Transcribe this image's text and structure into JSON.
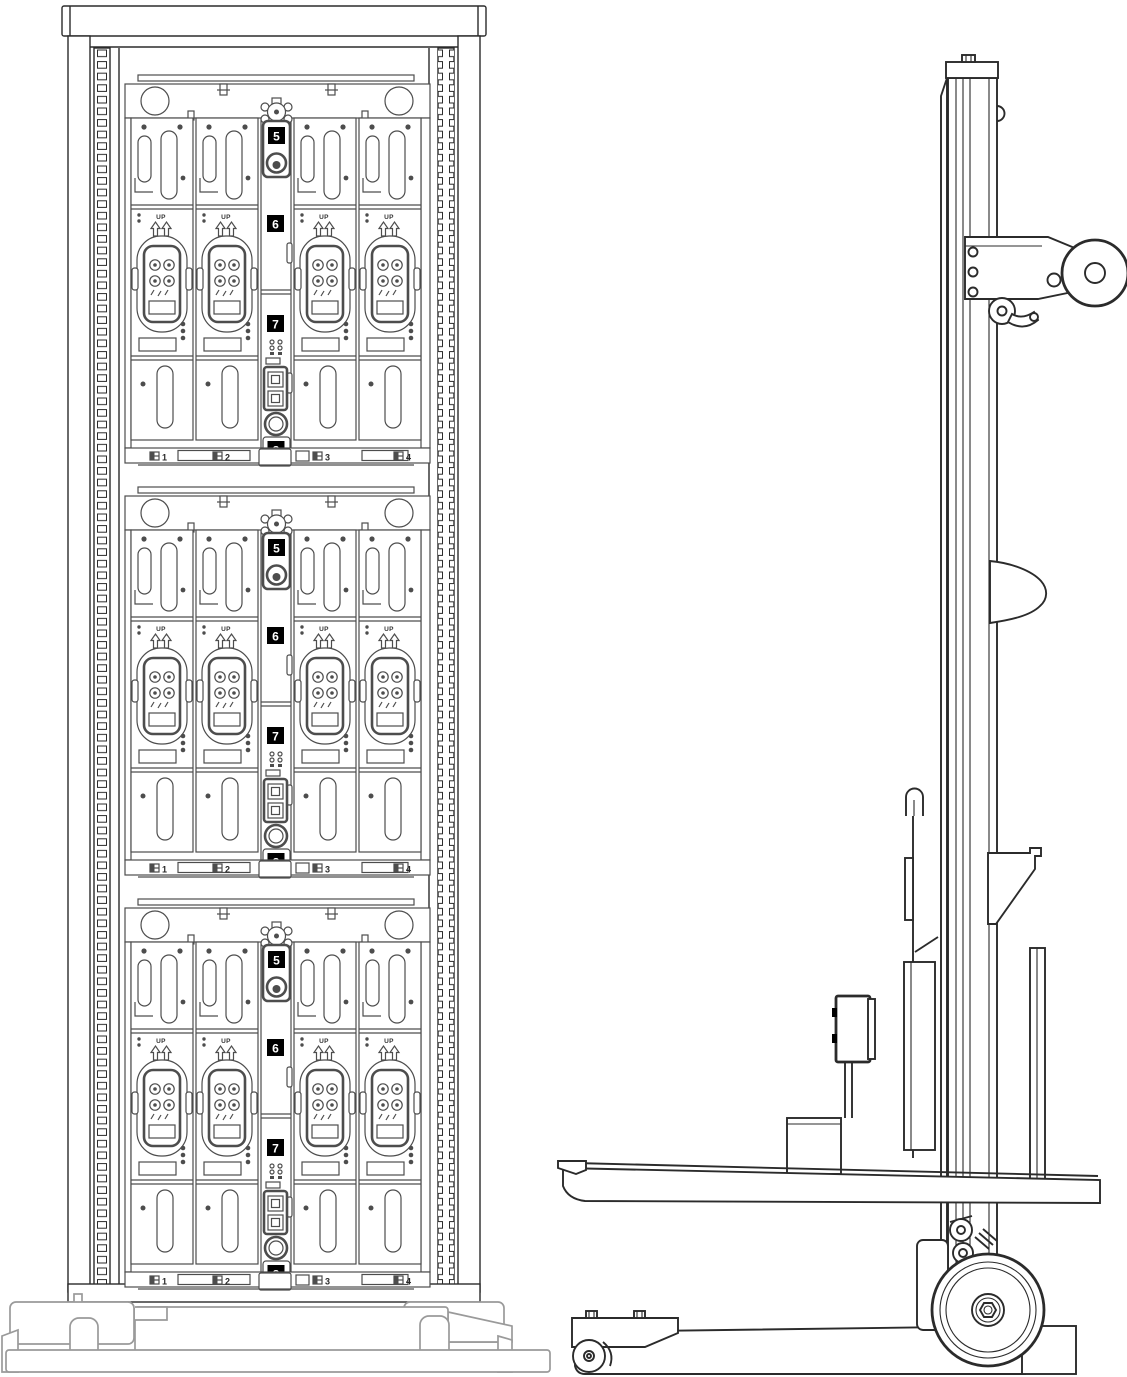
{
  "rack": {
    "up_label": "UP",
    "bay_labels": [
      "1",
      "2",
      "3",
      "4"
    ],
    "callouts": [
      "5",
      "6",
      "7",
      "8"
    ]
  },
  "colors": {
    "line": "#2b2b2b",
    "chassis": "#4d4d4d",
    "base": "#9a9a9a",
    "callout_bg": "#000000",
    "callout_fg": "#ffffff",
    "background": "#ffffff"
  }
}
